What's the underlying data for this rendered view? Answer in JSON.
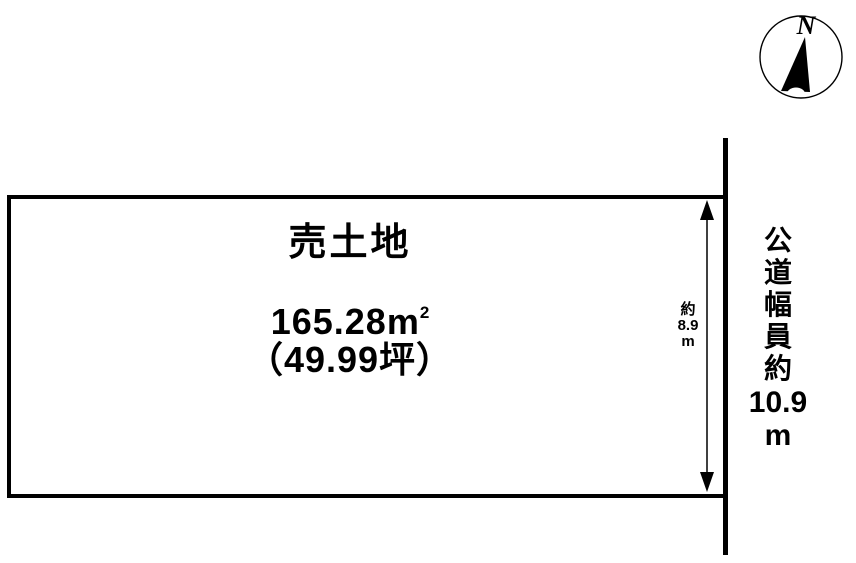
{
  "colors": {
    "ink": "#000000",
    "background": "#ffffff"
  },
  "compass": {
    "north_label": "N"
  },
  "plot": {
    "title": "売土地",
    "area_main": "165.28m",
    "area_exponent": "2",
    "area_tsubo": "（49.99坪）"
  },
  "depth_dim": {
    "approx": "約",
    "value": "8.9",
    "unit": "m"
  },
  "road": {
    "label_chars": [
      "公",
      "道",
      "幅",
      "員",
      "約"
    ],
    "width_value": "10.9",
    "width_unit": "m"
  }
}
